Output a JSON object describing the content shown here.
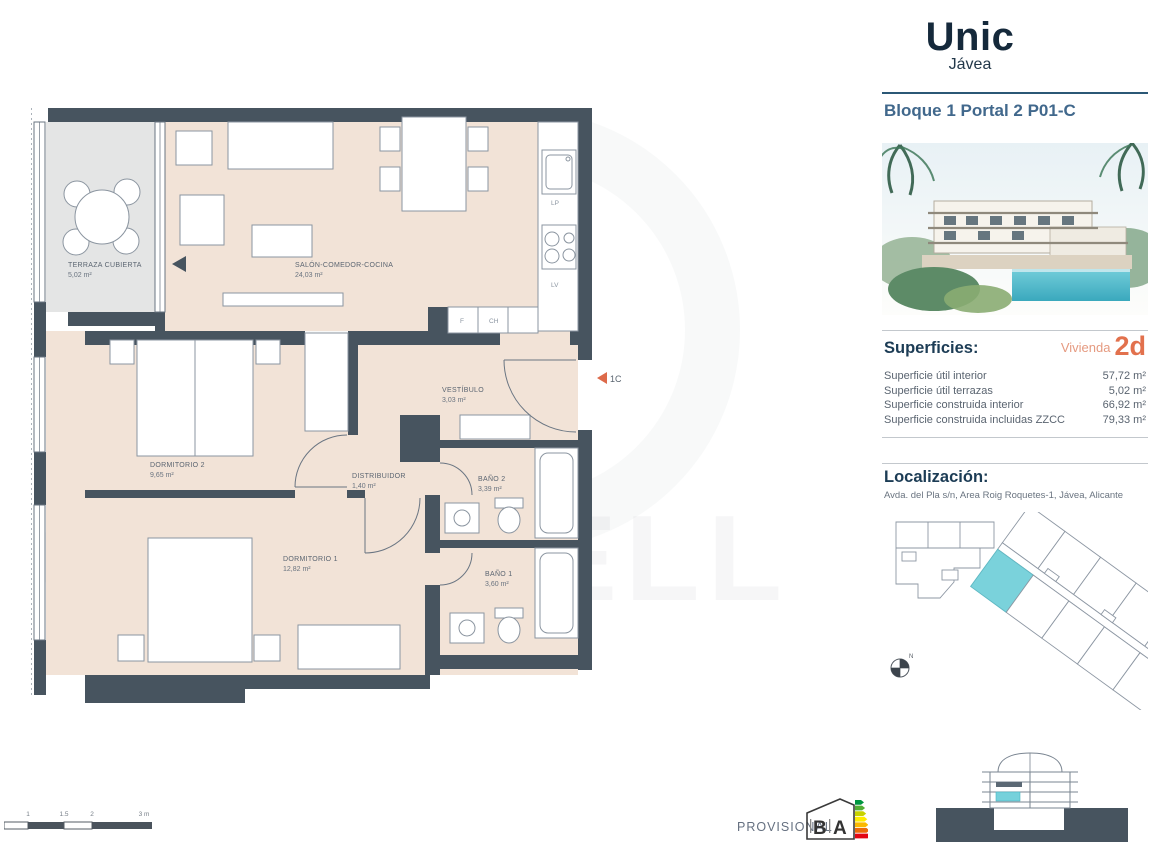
{
  "header": {
    "title": "Unic",
    "subtitle": "Jávea",
    "block": "Bloque 1 Portal 2 P01-C"
  },
  "superficies": {
    "heading": "Superficies:",
    "vivienda_label": "Vivienda",
    "vivienda_value": "2d",
    "rows": [
      {
        "label": "Superficie útil interior",
        "value": "57,72 m²"
      },
      {
        "label": "Superficie útil terrazas",
        "value": "5,02 m²"
      },
      {
        "label": "Superficie construida interior",
        "value": "66,92 m²"
      },
      {
        "label": "Superficie construida incluidas ZZCC",
        "value": "79,33 m²"
      }
    ]
  },
  "localizacion": {
    "heading": "Localización:",
    "address": "Avda. del Pla s/n, Area Roig Roquetes-1, Jávea, Alicante"
  },
  "plan": {
    "rooms": [
      {
        "name": "TERRAZA CUBIERTA",
        "area": "5,02 m²"
      },
      {
        "name": "SALÓN-COMEDOR-COCINA",
        "area": "24,03 m²"
      },
      {
        "name": "VESTÍBULO",
        "area": "3,03 m²"
      },
      {
        "name": "DORMITORIO 2",
        "area": "9,65 m²"
      },
      {
        "name": "DISTRIBUIDOR",
        "area": "1,40 m²"
      },
      {
        "name": "BAÑO 2",
        "area": "3,39 m²"
      },
      {
        "name": "DORMITORIO 1",
        "area": "12,82 m²"
      },
      {
        "name": "BAÑO 1",
        "area": "3,60 m²"
      }
    ],
    "kitchen": {
      "lp": "LP",
      "lv": "LV",
      "f": "F",
      "ch": "CH"
    },
    "entrance_label": "1C",
    "compass_label": "N",
    "scale_labels": [
      "1",
      "1.5",
      "2",
      "3 m"
    ]
  },
  "footer": {
    "provisional": "PROVISIONAL",
    "energy_letters": [
      "B",
      "A"
    ]
  },
  "watermark": "COLDWELL",
  "colors": {
    "wall": "#47545f",
    "floor": "#f2e3d7",
    "terrace": "#e4e5e5",
    "highlight_teal": "#76d1db",
    "accent_salmon": "#e2714d",
    "navy": "#1c3c55"
  }
}
